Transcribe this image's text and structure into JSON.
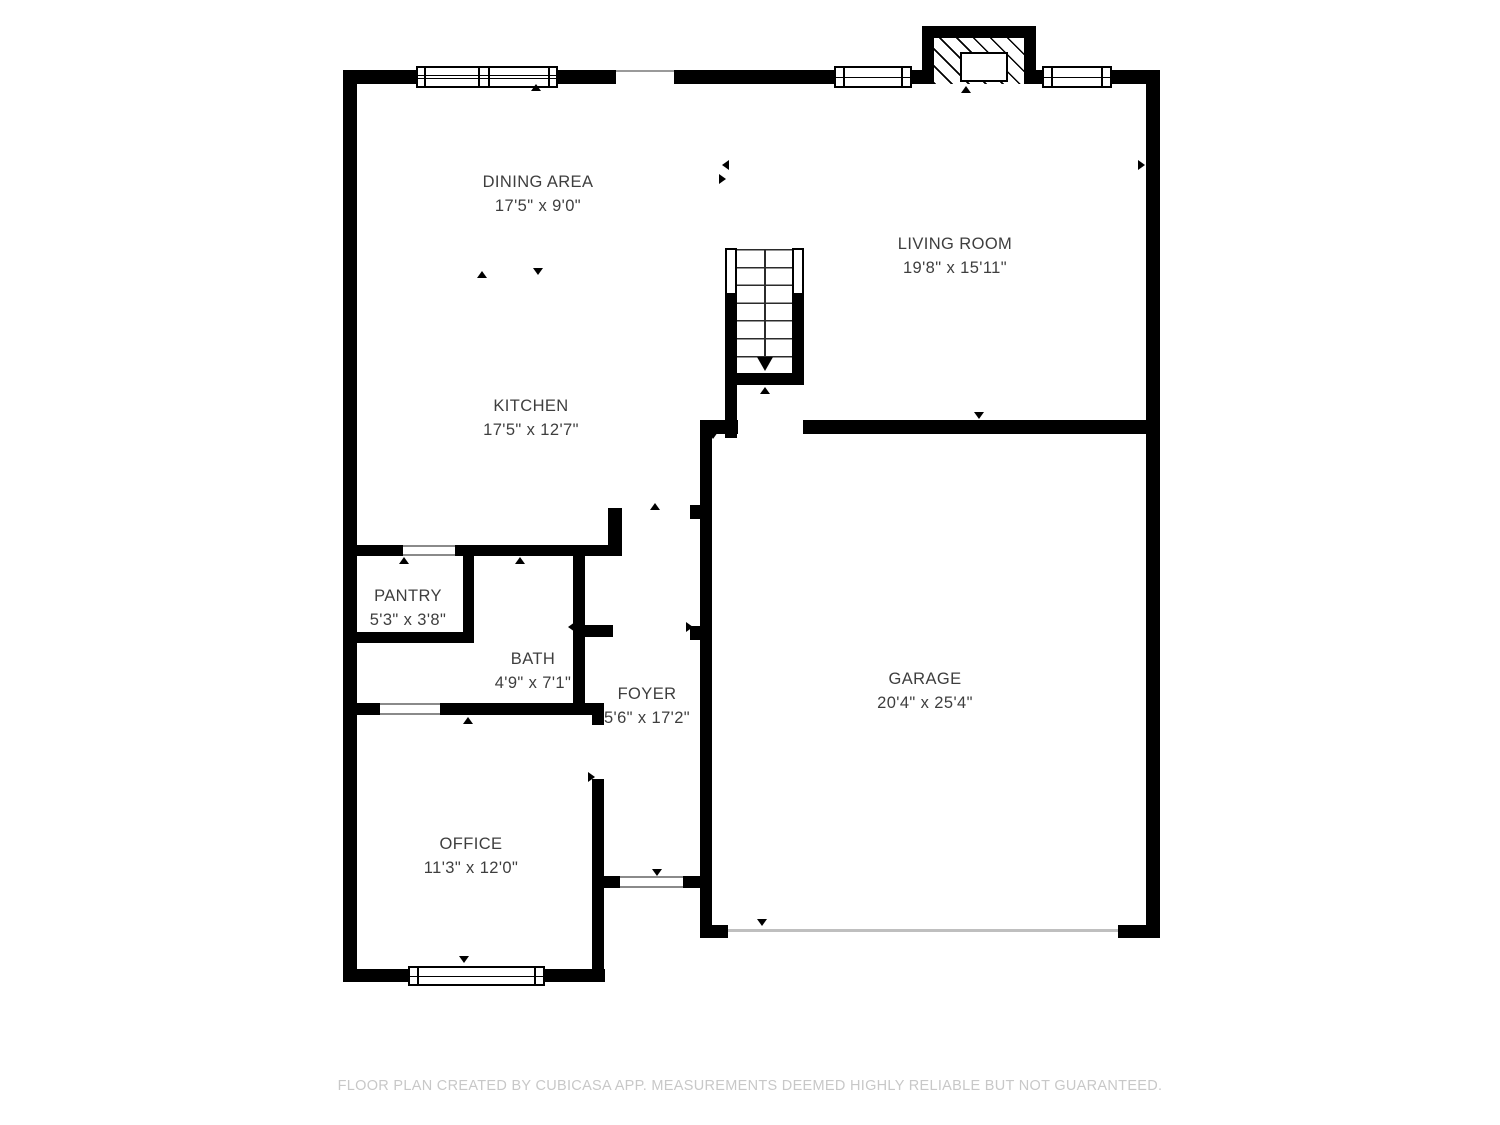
{
  "floorplan": {
    "rooms": [
      {
        "id": "dining-area",
        "label": "DINING AREA",
        "dimensions": "17'5\" x 9'0\""
      },
      {
        "id": "living-room",
        "label": "LIVING ROOM",
        "dimensions": "19'8\" x 15'11\""
      },
      {
        "id": "kitchen",
        "label": "KITCHEN",
        "dimensions": "17'5\" x 12'7\""
      },
      {
        "id": "pantry",
        "label": "PANTRY",
        "dimensions": "5'3\" x 3'8\""
      },
      {
        "id": "bath",
        "label": "BATH",
        "dimensions": "4'9\" x 7'1\""
      },
      {
        "id": "foyer",
        "label": "FOYER",
        "dimensions": "5'6\" x 17'2\""
      },
      {
        "id": "office",
        "label": "OFFICE",
        "dimensions": "11'3\" x 12'0\""
      },
      {
        "id": "garage",
        "label": "GARAGE",
        "dimensions": "20'4\" x 25'4\""
      }
    ],
    "footer": "FLOOR PLAN CREATED BY CUBICASA APP. MEASUREMENTS DEEMED HIGHLY RELIABLE BUT NOT GUARANTEED.",
    "colors": {
      "wall": "#000000",
      "label": "#3e3e3e",
      "footer": "#c8c8c8"
    }
  }
}
